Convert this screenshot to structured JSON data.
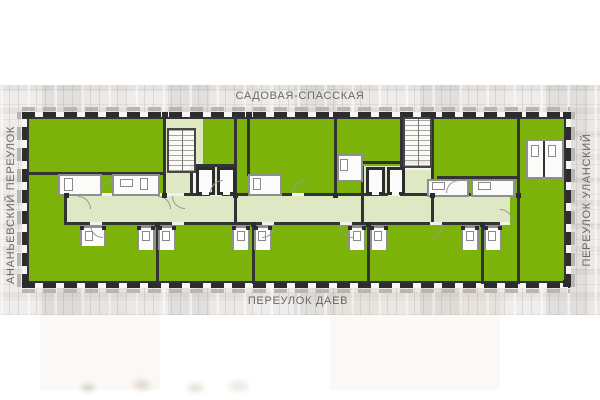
{
  "streets": {
    "top": "САДОВАЯ-СПАССКАЯ",
    "bottom": "ПЕРЕУЛОК ДАЕВ",
    "left": "АНАНЬЕВСКИЙ ПЕРЕУЛОК",
    "right": "ПЕРЕУЛОК УЛАНСКИЙ"
  },
  "colors": {
    "apartment_green": "#7cb30a",
    "wall_dark": "#333336",
    "window_dark": "#2c2c2e",
    "sill_gray": "#b9b6b2",
    "pod_gray": "#8f8f8f",
    "label_gray": "#6b6764",
    "photo_base": "#e9e7e5"
  }
}
